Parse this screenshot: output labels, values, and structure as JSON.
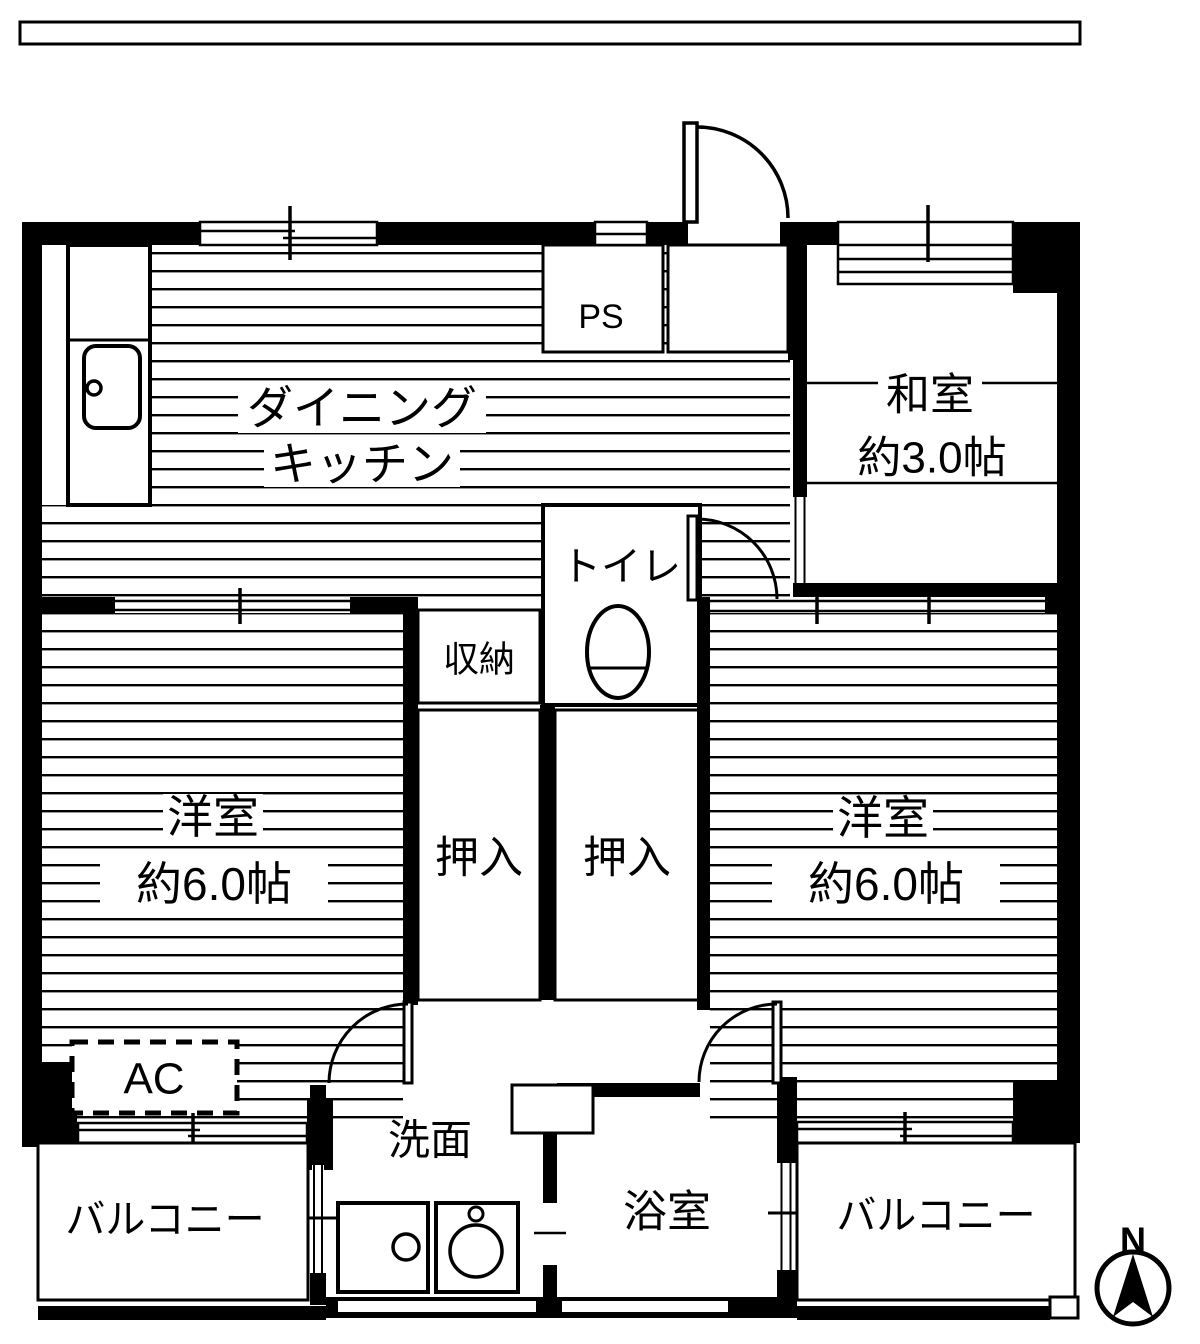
{
  "colors": {
    "line": "#000000",
    "background": "#ffffff"
  },
  "compass": {
    "north_label": "N"
  },
  "rooms": {
    "dining_kitchen": {
      "line1": "ダイニング",
      "line2": "キッチン"
    },
    "japanese_room": {
      "name": "和室",
      "size": "約3.0帖"
    },
    "western_room_left": {
      "name": "洋室",
      "size": "約6.0帖"
    },
    "western_room_right": {
      "name": "洋室",
      "size": "約6.0帖"
    },
    "toilet": {
      "name": "トイレ"
    },
    "storage": {
      "name": "収納"
    },
    "closet_left": {
      "name": "押入"
    },
    "closet_right": {
      "name": "押入"
    },
    "washroom": {
      "name": "洗面"
    },
    "bathroom": {
      "name": "浴室"
    },
    "balcony_left": {
      "name": "バルコニー"
    },
    "balcony_right": {
      "name": "バルコニー"
    },
    "pipe_space": {
      "name": "PS"
    },
    "air_conditioner": {
      "name": "AC"
    }
  }
}
